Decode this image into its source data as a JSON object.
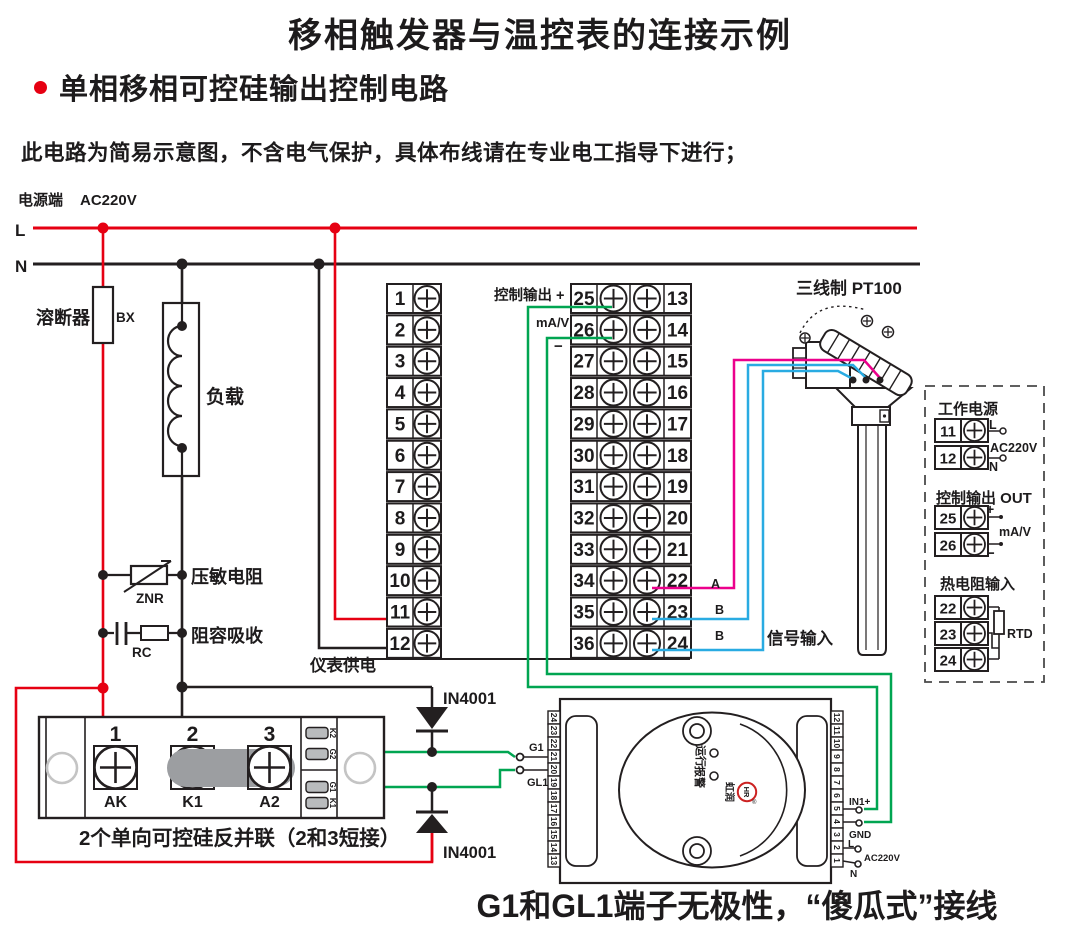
{
  "header": {
    "title": "移相触发器与温控表的连接示例",
    "subtitle": "单相移相可控硅输出控制电路",
    "note": "此电路为简易示意图，不含电气保护，具体布线请在专业电工指导下进行；"
  },
  "power": {
    "source_label": "电源端",
    "voltage": "AC220V",
    "line_live": "L",
    "line_neutral": "N"
  },
  "components": {
    "fuse_label": "溶断器",
    "fuse_code": "BX",
    "load_label": "负载",
    "varistor_label": "压敏电阻",
    "varistor_code": "ZNR",
    "rc_label": "阻容吸收",
    "rc_code": "RC"
  },
  "controller": {
    "left_terminals": [
      "1",
      "2",
      "3",
      "4",
      "5",
      "6",
      "7",
      "8",
      "9",
      "10",
      "11",
      "12"
    ],
    "mid_terminals": [
      "25",
      "26",
      "27",
      "28",
      "29",
      "30",
      "31",
      "32",
      "33",
      "34",
      "35",
      "36"
    ],
    "right_terminals": [
      "13",
      "14",
      "15",
      "16",
      "17",
      "18",
      "19",
      "20",
      "21",
      "22",
      "23",
      "24"
    ],
    "output_label": "控制输出 +",
    "output_unit": "mA/V",
    "output_minus": "−",
    "supply_label": "仪表供电",
    "wire_labels": {
      "a": "A",
      "b1": "B",
      "b2": "B"
    },
    "signal_label": "信号输入"
  },
  "sensor": {
    "label": "三线制 PT100"
  },
  "diodes": {
    "top": "IN4001",
    "bottom": "IN4001"
  },
  "scr_module": {
    "terminals": [
      {
        "num": "1",
        "label": "AK"
      },
      {
        "num": "2",
        "label": "K1"
      },
      {
        "num": "3",
        "label": "A2"
      }
    ],
    "gate_terminals": [
      "K2",
      "G2",
      "G1",
      "K1"
    ],
    "caption": "2个单向可控硅反并联（2和3短接）"
  },
  "trigger": {
    "left_terminals": [
      "24",
      "23",
      "22",
      "21",
      "20",
      "19",
      "18",
      "17",
      "16",
      "15",
      "14",
      "13"
    ],
    "right_terminals": [
      "12",
      "11",
      "10",
      "9",
      "8",
      "7",
      "6",
      "5",
      "4",
      "3",
      "2",
      "1"
    ],
    "g1": "G1",
    "gl1": "GL1",
    "run": "运行",
    "alarm": "报警",
    "brand": "虹润",
    "logo": "HR",
    "reg": "®",
    "in1": "IN1+",
    "gnd": "GND",
    "l": "L",
    "n": "N",
    "voltage": "AC220V"
  },
  "legend": {
    "power_title": "工作电源",
    "power_terminals": [
      "11",
      "12"
    ],
    "l": "L",
    "n": "N",
    "voltage": "AC220V",
    "output_title": "控制输出 OUT",
    "output_terminals": [
      "25",
      "26"
    ],
    "plus": "+",
    "minus": "−",
    "unit": "mA/V",
    "rtd_title": "热电阻输入",
    "rtd_terminals": [
      "22",
      "23",
      "24"
    ],
    "rtd": "RTD"
  },
  "footer": {
    "caption": "G1和GL1端子无极性，“傻瓜式”接线"
  },
  "colors": {
    "line_red": "#e60012",
    "wire_green": "#00a551",
    "wire_blue": "#29abe2",
    "wire_magenta": "#ec008c",
    "line_black": "#231f20",
    "shade_gray": "#9c9ea1",
    "logo_red": "#cc2222"
  }
}
